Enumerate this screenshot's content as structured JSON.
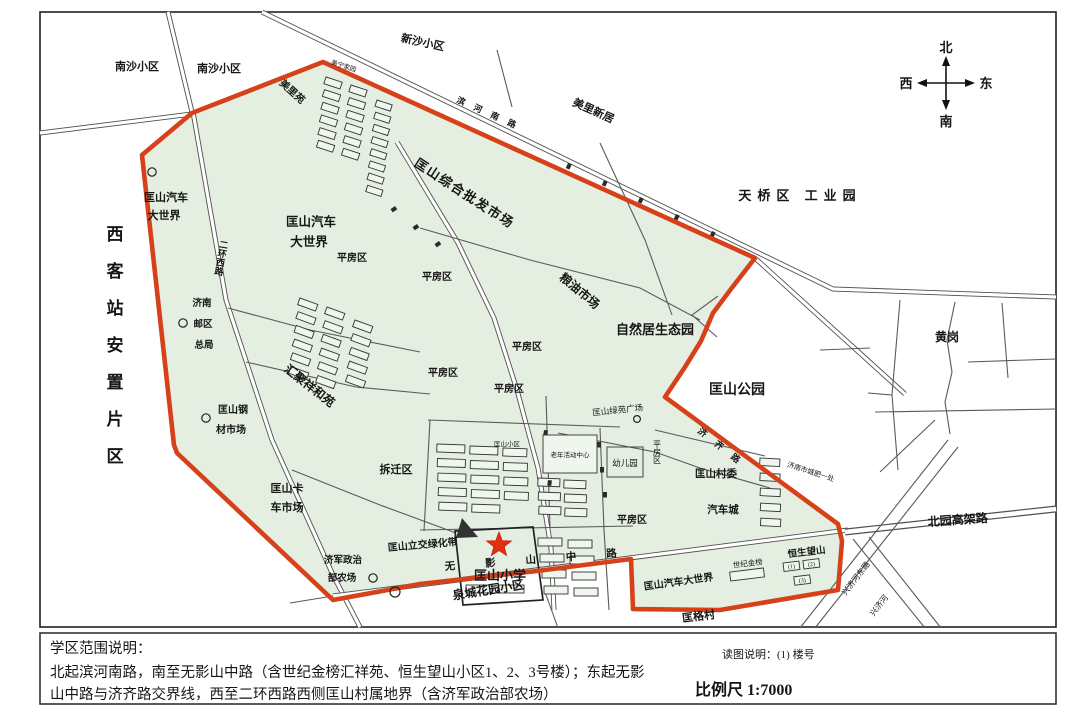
{
  "compass": {
    "north": "北",
    "south": "南",
    "east": "东",
    "west": "西"
  },
  "legend": {
    "title": "学区范围说明：",
    "line1": "北起滨河南路，南至无影山中路（含世纪金榜汇祥苑、恒生望山小区1、2、3号楼）；东起无影",
    "line2": "山中路与济齐路交界线，西至二环西路西侧匡山村属地界（含济军政治部农场）",
    "note": "读图说明：(1) 楼号",
    "scale": "比例尺 1:7000"
  },
  "school": {
    "name": "匡山小学"
  },
  "left_strip": {
    "text": "西客站安置片区"
  },
  "roads": {
    "erhuanxilu": "二环西路",
    "wuyingshanzhonglu": "无影山中路",
    "jiqilu": "济齐路",
    "binhenanlu": "滨河南路"
  },
  "buildings": {
    "hengsheng": [
      "(1)",
      "(2)",
      "(3)"
    ]
  },
  "labels": {
    "nansha1": "南沙小区",
    "nansha2": "南沙小区",
    "meiliyuan": "美里苑",
    "xinsha": "新沙小区",
    "meilixinju": "美里新居",
    "meining": "美宁家园",
    "tianqiao": "天桥区 工业园",
    "huanggang": "黄岗",
    "gongyuan": "匡山公园",
    "beiyuangaojialu": "北园高架路",
    "xingjihedonglu": "兴济河东路",
    "xingjihe": "兴济河",
    "chengfei": "济南市城肥一处",
    "quanchenghuayuan": "泉城花园小区",
    "kuanggecun": "匡格村",
    "qichedsj_s1": "匡山汽车",
    "qichedsj_s2": "大世界",
    "qichedsj_b1": "匡山汽车",
    "qichedsj_b2": "大世界",
    "qichedsj_bottom": "匡山汽车大世界",
    "pifashichang": "匡山综合批发市场",
    "liangyoushichang": "粮油市场",
    "ziranju": "自然居生态园",
    "huijuxianghe": "汇聚祥和苑",
    "youju1": "济南",
    "youju2": "邮区",
    "youju3": "总局",
    "gangcai1": "匡山钢",
    "gangcai2": "材市场",
    "chaiqianqu": "拆迁区",
    "kache1": "匡山卡",
    "kache2": "车市场",
    "lvhuadai": "匡山立交绿化带",
    "jijun1": "济军政治",
    "jijun2": "部农场",
    "pingfangqu": "平房区",
    "youeryuan": "幼儿园",
    "lvyuanguangchang": "匡山绿苑广场",
    "laonian": "老年活动中心",
    "kuangshanxiaoqu": "匡山小区",
    "cunwei": "匡山村委",
    "qichecheng": "汽车城",
    "shijijinbang": "世纪金榜",
    "hengshengwangshan": "恒生望山"
  }
}
